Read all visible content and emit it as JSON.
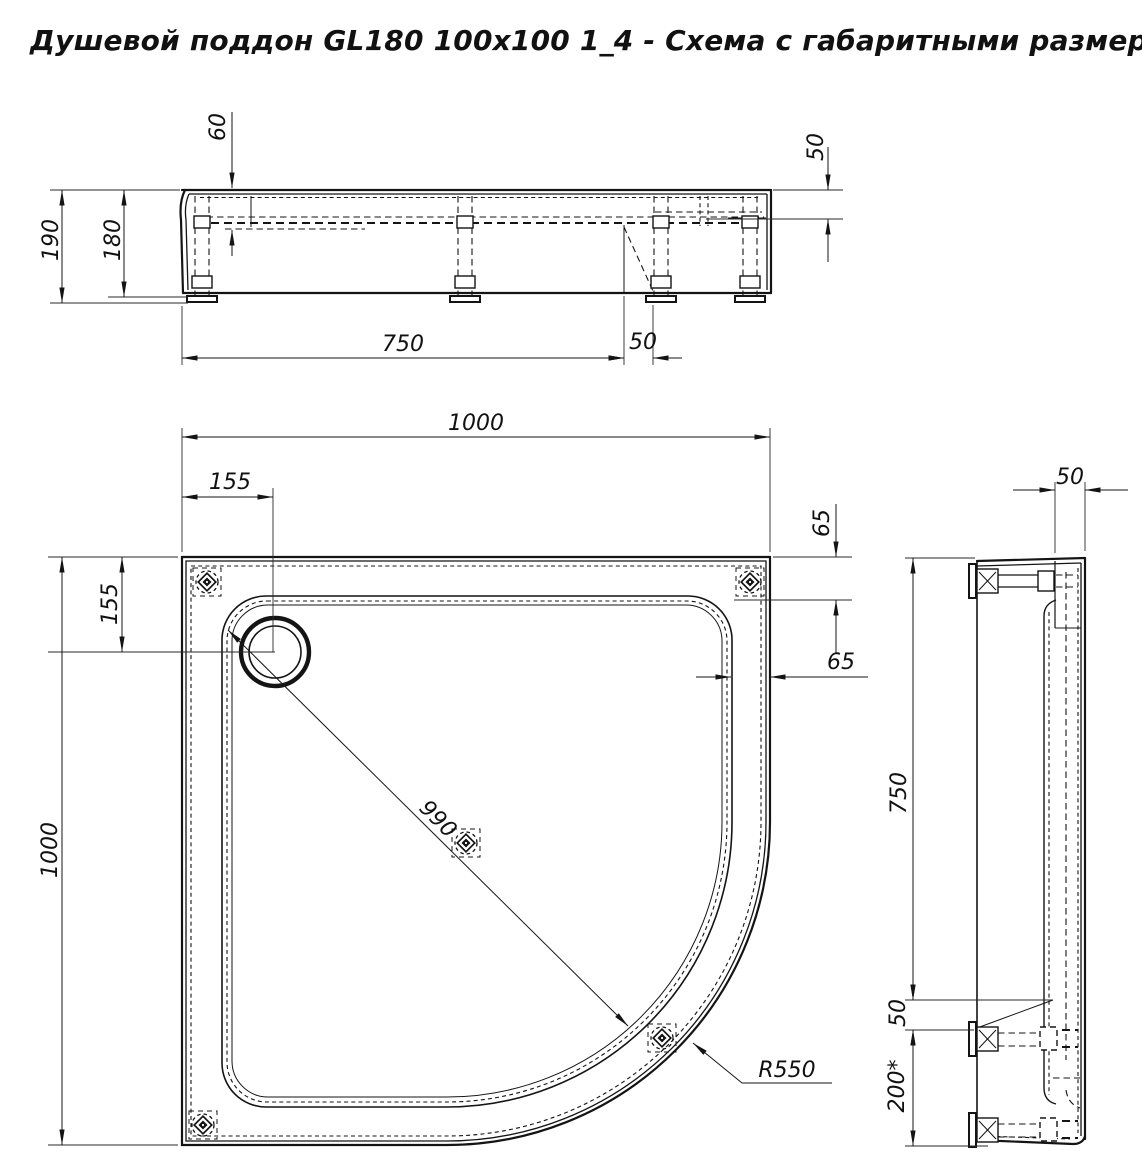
{
  "title": "Душевой поддон GL180 100x100 1_4 - Схема с габаритными размерами",
  "front_view": {
    "dims": {
      "bowl_depth": "60",
      "total_height": "190",
      "body_height": "180",
      "leg_span": "750",
      "leg_offset": "50",
      "rim_depth_right": "50"
    }
  },
  "plan_view": {
    "dims": {
      "overall_width": "1000",
      "overall_length": "1000",
      "drain_offset_x": "155",
      "drain_offset_y": "155",
      "foot_edge_offset": "65",
      "rim_width": "65",
      "inner_diagonal": "990",
      "corner_radius": "R550"
    }
  },
  "side_view": {
    "dims": {
      "rim_width_top": "50",
      "support_span": "750",
      "support_gap": "50",
      "drain_zone": "200*"
    }
  }
}
